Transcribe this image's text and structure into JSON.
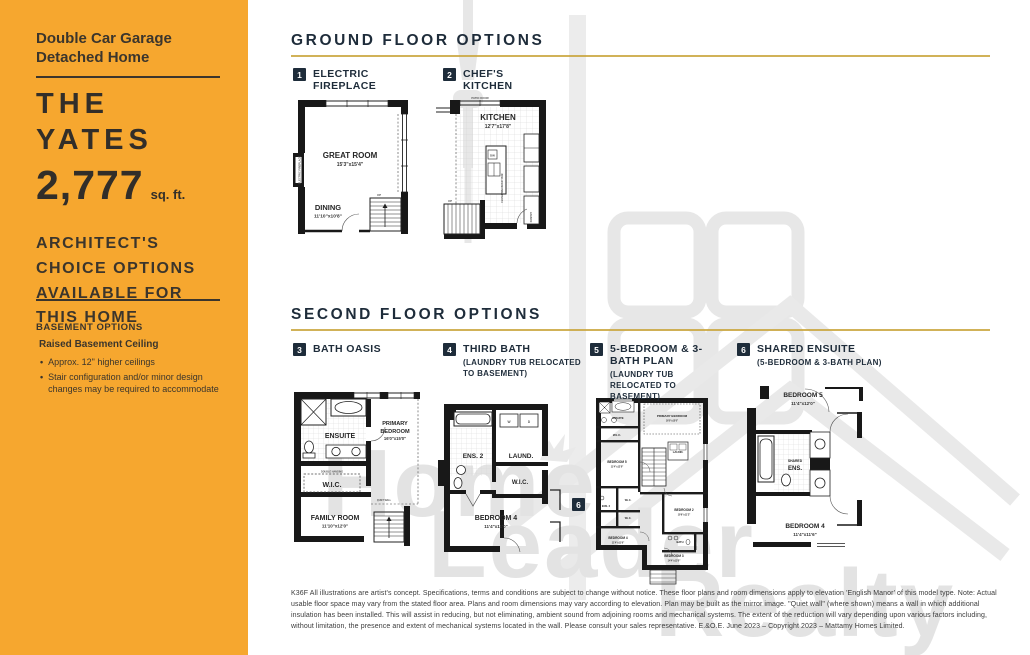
{
  "sidebar": {
    "subtitle": "Double Car Garage Detached Home",
    "model_line1": "THE",
    "model_line2": "YATES",
    "area_value": "2,777",
    "area_unit": "sq. ft.",
    "architects_note": "ARCHITECT'S CHOICE OPTIONS AVAILABLE FOR THIS HOME",
    "basement_title": "BASEMENT OPTIONS",
    "basement_feature": "Raised Basement Ceiling",
    "basement_bullets": [
      "Approx. 12\" higher ceilings",
      "Stair configuration and/or minor design changes may be required to accommodate"
    ]
  },
  "sections": {
    "ground_title": "GROUND FLOOR OPTIONS",
    "second_title": "SECOND FLOOR OPTIONS"
  },
  "options": {
    "o1": {
      "num": "1",
      "label": "ELECTRIC FIREPLACE"
    },
    "o2": {
      "num": "2",
      "label": "CHEF'S KITCHEN"
    },
    "o3": {
      "num": "3",
      "label": "BATH OASIS"
    },
    "o4": {
      "num": "4",
      "label": "THIRD BATH",
      "sub": "(LAUNDRY TUB RELOCATED TO BASEMENT)"
    },
    "o5": {
      "num": "5",
      "label": "5-BEDROOM & 3-BATH PLAN",
      "sub": "(LAUNDRY TUB RELOCATED TO BASEMENT)"
    },
    "o6": {
      "num": "6",
      "label": "SHARED ENSUITE",
      "sub": "(5-BEDROOM & 3-BATH PLAN)"
    }
  },
  "plans": {
    "p1": {
      "fireplace": "ELECTRIC FIREPLACE",
      "great_room": "GREAT ROOM",
      "great_room_dim": "15'3\"x15'4\"",
      "dining": "DINING",
      "dining_dim": "11'10\"x10'8\"",
      "up": "UP"
    },
    "p2": {
      "kitchen": "KITCHEN",
      "kitchen_dim": "12'7\"x17'8\"",
      "patio_door": "PATIO DOOR",
      "island": "FLUSH BREAKFAST BAR",
      "dw": "DW",
      "pantry": "PANTRY",
      "up": "UP"
    },
    "p3": {
      "ensuite": "ENSUITE",
      "primary_l1": "PRIMARY",
      "primary_l2": "BEDROOM",
      "primary_dim": "16'0\"x15'0\"",
      "wic": "W.I.C.",
      "wic_note": "DOUBLE HANGING",
      "quiet_wall": "QUIET WALL",
      "family": "FAMILY ROOM",
      "family_dim": "11'10\"x12'0\""
    },
    "p4": {
      "ens2": "ENS. 2",
      "laund": "LAUND.",
      "wic": "W.I.C.",
      "bedroom4": "BEDROOM 4",
      "bedroom4_dim": "11'4\"x11'0\"",
      "w": "W",
      "d": "D"
    },
    "p5": {
      "badge": "6",
      "ensuite": "ENSUITE",
      "primary": "PRIMARY BEDROOM",
      "primary_dim": "16'0\"x15'0\"",
      "wic1": "W.I.C.",
      "laund": "LAUND.",
      "bedroom5": "BEDROOM 5",
      "bedroom5_dim": "11'4\"x12'0\"",
      "ens2": "ENS. 2",
      "wic2": "W.I.C.",
      "wic3": "W.I.C.",
      "bedroom2": "BEDROOM 2",
      "bedroom2_dim": "10'6\"x11'2\"",
      "bedroom4": "BEDROOM 4",
      "bedroom4_dim": "11'4\"x11'6\"",
      "bath": "BATH",
      "bedroom3": "BEDROOM 3",
      "bedroom3_dim": "14'4\"x13'0\""
    },
    "p6": {
      "bedroom5": "BEDROOM 5",
      "bedroom5_dim": "11'4\"x12'0\"",
      "shared_l1": "SHARED",
      "shared_l2": "ENS.",
      "bedroom4": "BEDROOM 4",
      "bedroom4_dim": "11'4\"x11'6\""
    }
  },
  "watermark": {
    "word1": "Home",
    "word2": "Leader",
    "word3": "Realty"
  },
  "footer": {
    "disclaimer": "K36F All illustrations are artist's concept. Specifications, terms and conditions are subject to change without notice. These floor plans and room dimensions apply to elevation 'English Manor' of this model type. Note: Actual usable floor space may vary from the stated floor area. Plans and room dimensions may vary according to elevation. Plan may be built as the mirror image. \"Quiet wall\" (where shown) means a wall in which additional insulation has been installed. This will assist in reducing, but not eliminating, ambient sound from adjoining rooms and mechanical systems. The extent of the reduction will vary depending upon various factors including, without limitation, the presence and extent of mechanical systems located in the wall. Please consult your sales representative. E.&O.E. June 2023 – Copyright 2023 – Mattamy Homes Limited."
  },
  "colors": {
    "sidebar_orange": "#F6A72F",
    "heading_navy": "#1E2C3A",
    "rule_gold": "#C9A43B",
    "watermark_gray": "#E4E4E4"
  }
}
